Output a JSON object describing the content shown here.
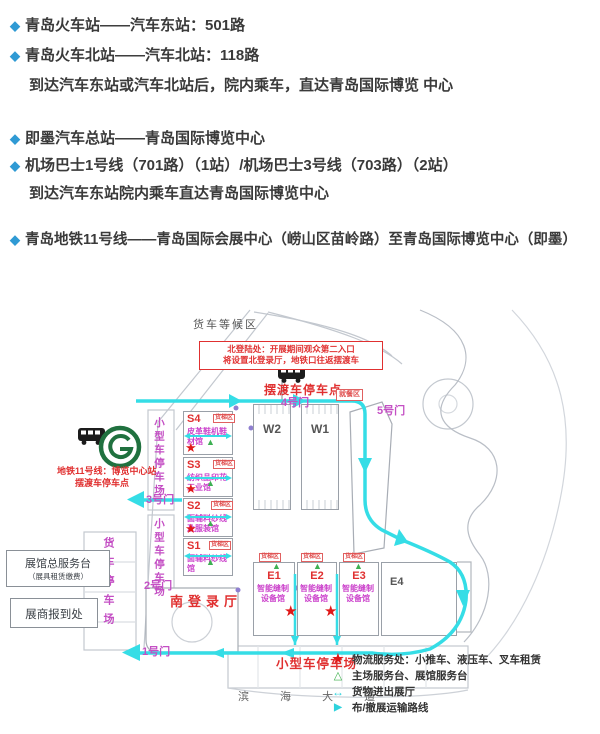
{
  "transport": {
    "bullet_icon": "◆",
    "lines": [
      {
        "text": "青岛火车站——汽车东站：501路"
      },
      {
        "text": "青岛火车北站——汽车北站：118路"
      },
      {
        "text": "到达汽车东站或汽车北站后，院内乘车，直达青岛国际博览 中心"
      },
      {
        "text": "即墨汽车总站——青岛国际博览中心"
      },
      {
        "text": "机场巴士1号线（701路）（1站）/机场巴士3号线（703路）（2站）"
      },
      {
        "text": "到达汽车东站院内乘车直达青岛国际博览中心"
      },
      {
        "text": "青岛地铁11号线——青岛国际会展中心（崂山区苗岭路）至青岛国际博览中心（即墨）"
      }
    ]
  },
  "map": {
    "truck_waiting_area": "货车等候区",
    "north_note": {
      "line1": "北登陆处：开展期间观众第二入口",
      "line2": "将设置北登录厅，地铁口往返摆渡车"
    },
    "shuttle_stop_north": "摆渡车停车点",
    "gates": {
      "g1": "1号门",
      "g2": "2号门",
      "g3": "3号门",
      "g4": "4号门",
      "g5": "5号门"
    },
    "metro": {
      "line1": "地铁11号线：博览中心站",
      "line2": "摆渡车停车点"
    },
    "parking": {
      "small_left_top": "小型车停车场",
      "small_left_mid": "小型车停车场",
      "truck_left": "货车停车场",
      "small_bottom": "小型车停车场"
    },
    "service_center": {
      "line1": "展馆总服务台",
      "line2": "（展具租赁缴费）"
    },
    "registration": "展商报到处",
    "south_hall": "南登录厅",
    "dining_area": "就餐区",
    "freight_elevator": "货梯区",
    "binhai_avenue": "滨 海 大 道",
    "halls": {
      "s4": {
        "id": "S4",
        "name": "皮革鞋机鞋材馆"
      },
      "s3": {
        "id": "S3",
        "name": "纺织品印花工业馆"
      },
      "s2": {
        "id": "S2",
        "name": "面辅料纱线及服装馆"
      },
      "s1": {
        "id": "S1",
        "name": "面辅料纱线馆"
      },
      "w2": {
        "id": "W2"
      },
      "w1": {
        "id": "W1"
      },
      "e1": {
        "id": "E1",
        "name": "智能缝制设备馆"
      },
      "e2": {
        "id": "E2",
        "name": "智能缝制设备馆"
      },
      "e3": {
        "id": "E3",
        "name": "智能缝制设备馆"
      },
      "e4": {
        "id": "E4"
      }
    },
    "icons": {
      "marker_star": "★",
      "marker_triangle": "▲",
      "legend_star": "★",
      "legend_triangle": "△",
      "legend_inout": "↔",
      "legend_route": "▶"
    },
    "legend": {
      "items": [
        {
          "text": "物流服务处：小推车、液压车、叉车租赁"
        },
        {
          "text": "主场服务台、展馆服务台"
        },
        {
          "text": "货物进出展厅"
        },
        {
          "text": "布/撤展运输路线"
        }
      ]
    },
    "colors": {
      "route_cyan": "#35dde6",
      "gate_magenta": "#c44fc4",
      "hall_name_magenta": "#cc44cc",
      "alert_red": "#e02020",
      "marker_green": "#3cb04a"
    }
  }
}
